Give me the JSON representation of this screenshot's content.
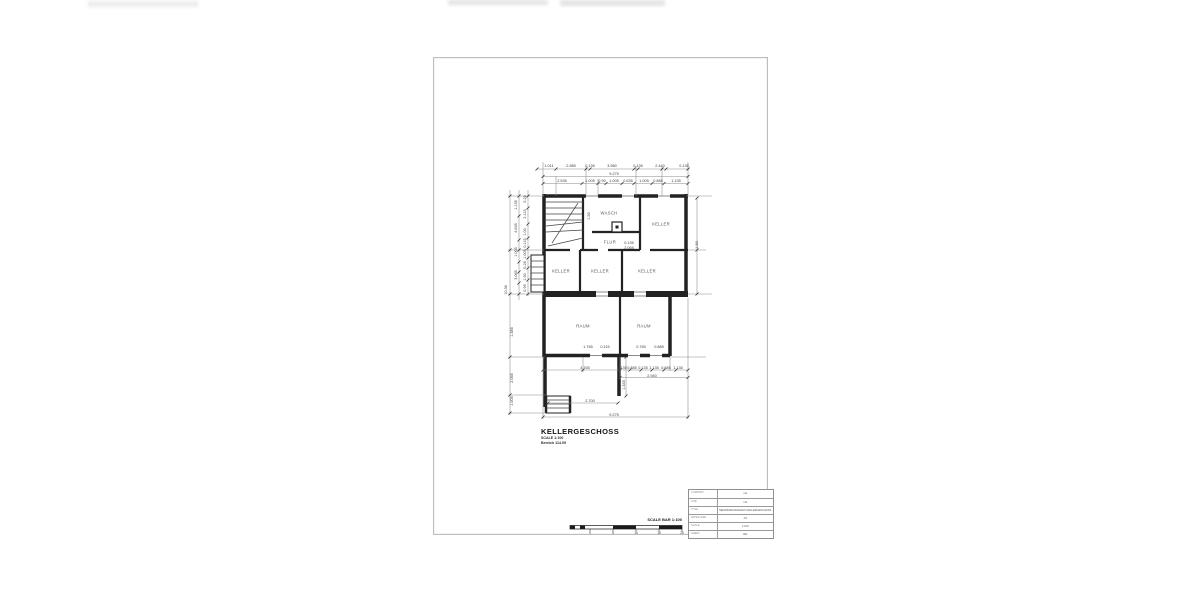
{
  "drawing": {
    "title": "KELLERGESCHOSS",
    "scale_note": "SCALE 1:100",
    "area_note": "Bereich 114.09",
    "rooms": [
      {
        "label": "WASCH",
        "x": 609,
        "y": 213
      },
      {
        "label": "KELLER",
        "x": 661,
        "y": 224
      },
      {
        "label": "FLUR",
        "x": 610,
        "y": 242
      },
      {
        "label": "KELLER",
        "x": 561,
        "y": 271
      },
      {
        "label": "KELLER",
        "x": 600,
        "y": 271
      },
      {
        "label": "KELLER",
        "x": 647,
        "y": 271
      },
      {
        "label": "RAUM",
        "x": 583,
        "y": 326
      },
      {
        "label": "RAUM",
        "x": 644,
        "y": 326
      }
    ],
    "dimensions": [
      {
        "t": "1.011",
        "x": 549,
        "y": 166,
        "r": 0
      },
      {
        "t": "2.985",
        "x": 571,
        "y": 166,
        "r": 0
      },
      {
        "t": "0.135",
        "x": 590,
        "y": 166,
        "r": 0
      },
      {
        "t": "3.980",
        "x": 612,
        "y": 166,
        "r": 0
      },
      {
        "t": "0.135",
        "x": 638,
        "y": 166,
        "r": 0
      },
      {
        "t": "2.440",
        "x": 660,
        "y": 166,
        "r": 0
      },
      {
        "t": "0.135",
        "x": 684,
        "y": 166,
        "r": 0
      },
      {
        "t": "9.275",
        "x": 614,
        "y": 173.5,
        "r": 0
      },
      {
        "t": "2.535",
        "x": 562,
        "y": 181,
        "r": 0
      },
      {
        "t": "1.005",
        "x": 590,
        "y": 181,
        "r": 0
      },
      {
        "t": "0.90",
        "x": 602,
        "y": 181,
        "r": 0
      },
      {
        "t": "1.005",
        "x": 614,
        "y": 181,
        "r": 0
      },
      {
        "t": "0.635",
        "x": 628,
        "y": 181,
        "r": 0
      },
      {
        "t": "1.005",
        "x": 644,
        "y": 181,
        "r": 0
      },
      {
        "t": "0.885",
        "x": 658,
        "y": 181,
        "r": 0
      },
      {
        "t": "1.135",
        "x": 676,
        "y": 181,
        "r": 0
      },
      {
        "t": "10.36",
        "x": 506,
        "y": 290,
        "r": -90
      },
      {
        "t": "1.135",
        "x": 516,
        "y": 205,
        "r": -90
      },
      {
        "t": "4.635",
        "x": 516,
        "y": 228,
        "r": -90
      },
      {
        "t": "1.005",
        "x": 516,
        "y": 252,
        "r": -90
      },
      {
        "t": "3.065",
        "x": 516,
        "y": 275,
        "r": -90
      },
      {
        "t": "0.26",
        "x": 525,
        "y": 199,
        "r": -90
      },
      {
        "t": "2.115",
        "x": 525,
        "y": 214,
        "r": -90
      },
      {
        "t": "1.00",
        "x": 525,
        "y": 232,
        "r": -90
      },
      {
        "t": "0.115",
        "x": 525,
        "y": 243,
        "r": -90
      },
      {
        "t": "1.005",
        "x": 525,
        "y": 254,
        "r": -90
      },
      {
        "t": "0.26",
        "x": 525,
        "y": 265,
        "r": -90
      },
      {
        "t": "1.50",
        "x": 525,
        "y": 277,
        "r": -90
      },
      {
        "t": "0.99",
        "x": 525,
        "y": 288,
        "r": -90
      },
      {
        "t": "1.385",
        "x": 512,
        "y": 332,
        "r": -90
      },
      {
        "t": "2.065",
        "x": 512,
        "y": 378,
        "r": -90
      },
      {
        "t": "1.005",
        "x": 512,
        "y": 401,
        "r": -90
      },
      {
        "t": "1.50",
        "x": 697,
        "y": 245,
        "r": -90
      },
      {
        "t": "1.50",
        "x": 589,
        "y": 216,
        "r": -90
      },
      {
        "t": "0.135",
        "x": 629,
        "y": 243,
        "r": 0
      },
      {
        "t": "2.065",
        "x": 629,
        "y": 248,
        "r": 0
      },
      {
        "t": "1.765",
        "x": 588,
        "y": 347,
        "r": 0
      },
      {
        "t": "0.115",
        "x": 605,
        "y": 347,
        "r": 0
      },
      {
        "t": "0.765",
        "x": 641,
        "y": 347,
        "r": 0
      },
      {
        "t": "0.885",
        "x": 659,
        "y": 347,
        "r": 0
      },
      {
        "t": "4.765",
        "x": 585,
        "y": 368,
        "r": 0
      },
      {
        "t": "0.135",
        "x": 622,
        "y": 368,
        "r": 0
      },
      {
        "t": "0.885",
        "x": 632,
        "y": 368,
        "r": 0
      },
      {
        "t": "0.135",
        "x": 643,
        "y": 368,
        "r": 0
      },
      {
        "t": "1.135",
        "x": 654,
        "y": 368,
        "r": 0
      },
      {
        "t": "0.885",
        "x": 666,
        "y": 368,
        "r": 0
      },
      {
        "t": "1.135",
        "x": 678,
        "y": 368,
        "r": 0
      },
      {
        "t": "2.940",
        "x": 652,
        "y": 376,
        "r": 0
      },
      {
        "t": "1.345",
        "x": 624,
        "y": 385,
        "r": -90
      },
      {
        "t": "2.700",
        "x": 590,
        "y": 400.5,
        "r": 0
      },
      {
        "t": "9.275",
        "x": 614,
        "y": 414.5,
        "r": 0
      }
    ]
  },
  "scale_bar": {
    "label": "SCALE BAR 1:100",
    "ticks": [
      {
        "text": "0",
        "x": 590
      },
      {
        "text": "5",
        "x": 613
      },
      {
        "text": "10",
        "x": 636
      },
      {
        "text": "15",
        "x": 659
      },
      {
        "text": "20",
        "x": 682
      }
    ]
  },
  "title_block": {
    "rows": [
      {
        "label": "COMPANY",
        "value": "n/a"
      },
      {
        "label": "SITE",
        "value": "n/a"
      },
      {
        "label": "TITLE",
        "value": "MEHRFAMILIENHAUS KELLERGESCHOSS"
      },
      {
        "label": "PAPER SIZE",
        "value": "A3"
      },
      {
        "label": "SCALE",
        "value": "1:100"
      },
      {
        "label": "SHEET",
        "value": "A01"
      }
    ]
  }
}
